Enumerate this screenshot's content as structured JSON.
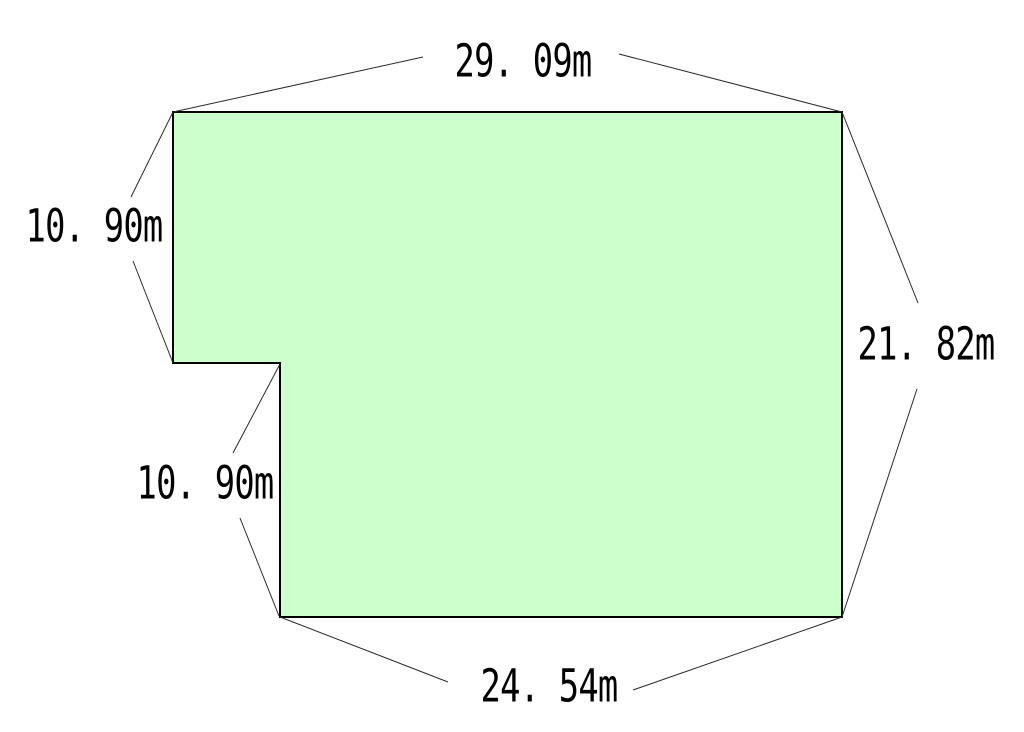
{
  "diagram": {
    "title": "land-parcel-dimension-diagram",
    "background_color": "#ffffff",
    "parcel": {
      "fill_color": "#ccffcc",
      "outline_color": "#000000"
    },
    "labels": {
      "top": {
        "text": "29. 09m",
        "value_m": 29.09,
        "side": "top edge"
      },
      "left_upper": {
        "text": "10. 90m",
        "value_m": 10.9,
        "side": "upper left edge"
      },
      "left_lower": {
        "text": "10. 90m",
        "value_m": 10.9,
        "side": "lower left (notch) edge"
      },
      "right": {
        "text": "21. 82m",
        "value_m": 21.82,
        "side": "right edge"
      },
      "bottom": {
        "text": "24. 54m",
        "value_m": 24.54,
        "side": "bottom edge"
      }
    }
  }
}
